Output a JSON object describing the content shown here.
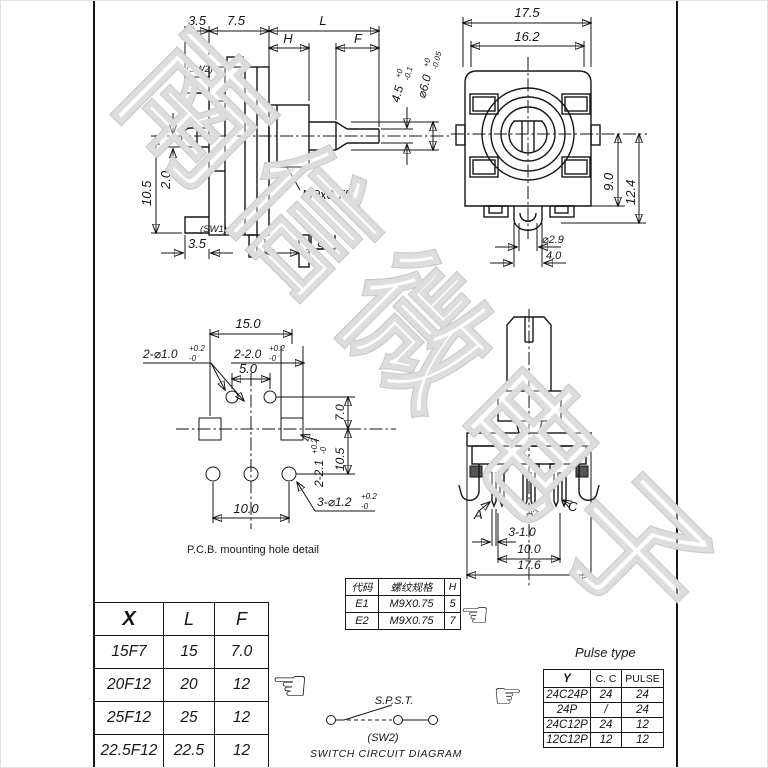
{
  "watermark": {
    "text": "南信微电子"
  },
  "icons": {
    "hand_left": "☜",
    "hand_right": "☞"
  },
  "side_view": {
    "sw2": "(SW2)",
    "sw1": "(SW1)",
    "dim_top_3_5": "3.5",
    "dim_top_7_5": "7.5",
    "dim_L": "L",
    "dim_H": "H",
    "dim_F": "F",
    "dim_flat": "4.5",
    "dim_flat_tol_up": "+0",
    "dim_flat_tol_dn": "-0.1",
    "dim_dia": "⌀6.0",
    "dim_dia_tol_up": "+0",
    "dim_dia_tol_dn": "-0.05",
    "dim_10_5": "10.5",
    "dim_2_0": "2.0",
    "dim_bot_3_5": "3.5",
    "dim_1_9": "1.9",
    "thread": "M9x0.75"
  },
  "front_view": {
    "dim_17_5": "17.5",
    "dim_16_2": "16.2",
    "dim_9_0": "9.0",
    "dim_12_4": "12.4",
    "dim_2_9": "⌀2.9",
    "dim_4_0": "4.0"
  },
  "pcb_detail": {
    "dim_15_0": "15.0",
    "dim_slot20": "2-2.0",
    "dim_slot20_up": "+0.2",
    "dim_slot20_dn": "-0",
    "dim_5_0": "5.0",
    "dim_hole10": "2-⌀1.0",
    "dim_hole10_up": "+0.2",
    "dim_hole10_dn": "-0",
    "dim_7_0": "7.0",
    "dim_10_5": "10.5",
    "dim_slot21": "2-2.1",
    "dim_slot21_up": "+0.2",
    "dim_slot21_dn": "-0",
    "dim_10_0": "10.0",
    "dim_hole12": "3-⌀1.2",
    "dim_hole12_up": "+0.2",
    "dim_hole12_dn": "-0",
    "caption": "P.C.B.  mounting hole detail"
  },
  "rear_view": {
    "term_a": "A",
    "term_b": "B",
    "term_c": "C",
    "dim_3_1_0": "3-1.0",
    "dim_10_0": "10.0",
    "dim_17_6": "17.6"
  },
  "thread_table": {
    "col_code": "代码",
    "col_spec": "螺纹规格",
    "col_h": "H",
    "rows": [
      {
        "code": "E1",
        "spec": "M9X0.75",
        "h": "5"
      },
      {
        "code": "E2",
        "spec": "M9X0.75",
        "h": "7"
      }
    ]
  },
  "xlf_table": {
    "col_x": "X",
    "col_l": "L",
    "col_f": "F",
    "rows": [
      {
        "x": "15F7",
        "l": "15",
        "f": "7.0"
      },
      {
        "x": "20F12",
        "l": "20",
        "f": "12"
      },
      {
        "x": "25F12",
        "l": "25",
        "f": "12"
      },
      {
        "x": "22.5F12",
        "l": "22.5",
        "f": "12"
      }
    ]
  },
  "switch_diagram": {
    "type": "S.P.S.T.",
    "label": "(SW2)",
    "caption": "SWITCH CIRCUIT DIAGRAM"
  },
  "pulse_table": {
    "title": "Pulse type",
    "col_y": "Y",
    "col_cc": "C. C",
    "col_pulse": "PULSE",
    "rows": [
      {
        "y": "24C24P",
        "cc": "24",
        "pulse": "24"
      },
      {
        "y": "24P",
        "cc": "/",
        "pulse": "24"
      },
      {
        "y": "24C12P",
        "cc": "24",
        "pulse": "12"
      },
      {
        "y": "12C12P",
        "cc": "12",
        "pulse": "12"
      }
    ]
  }
}
